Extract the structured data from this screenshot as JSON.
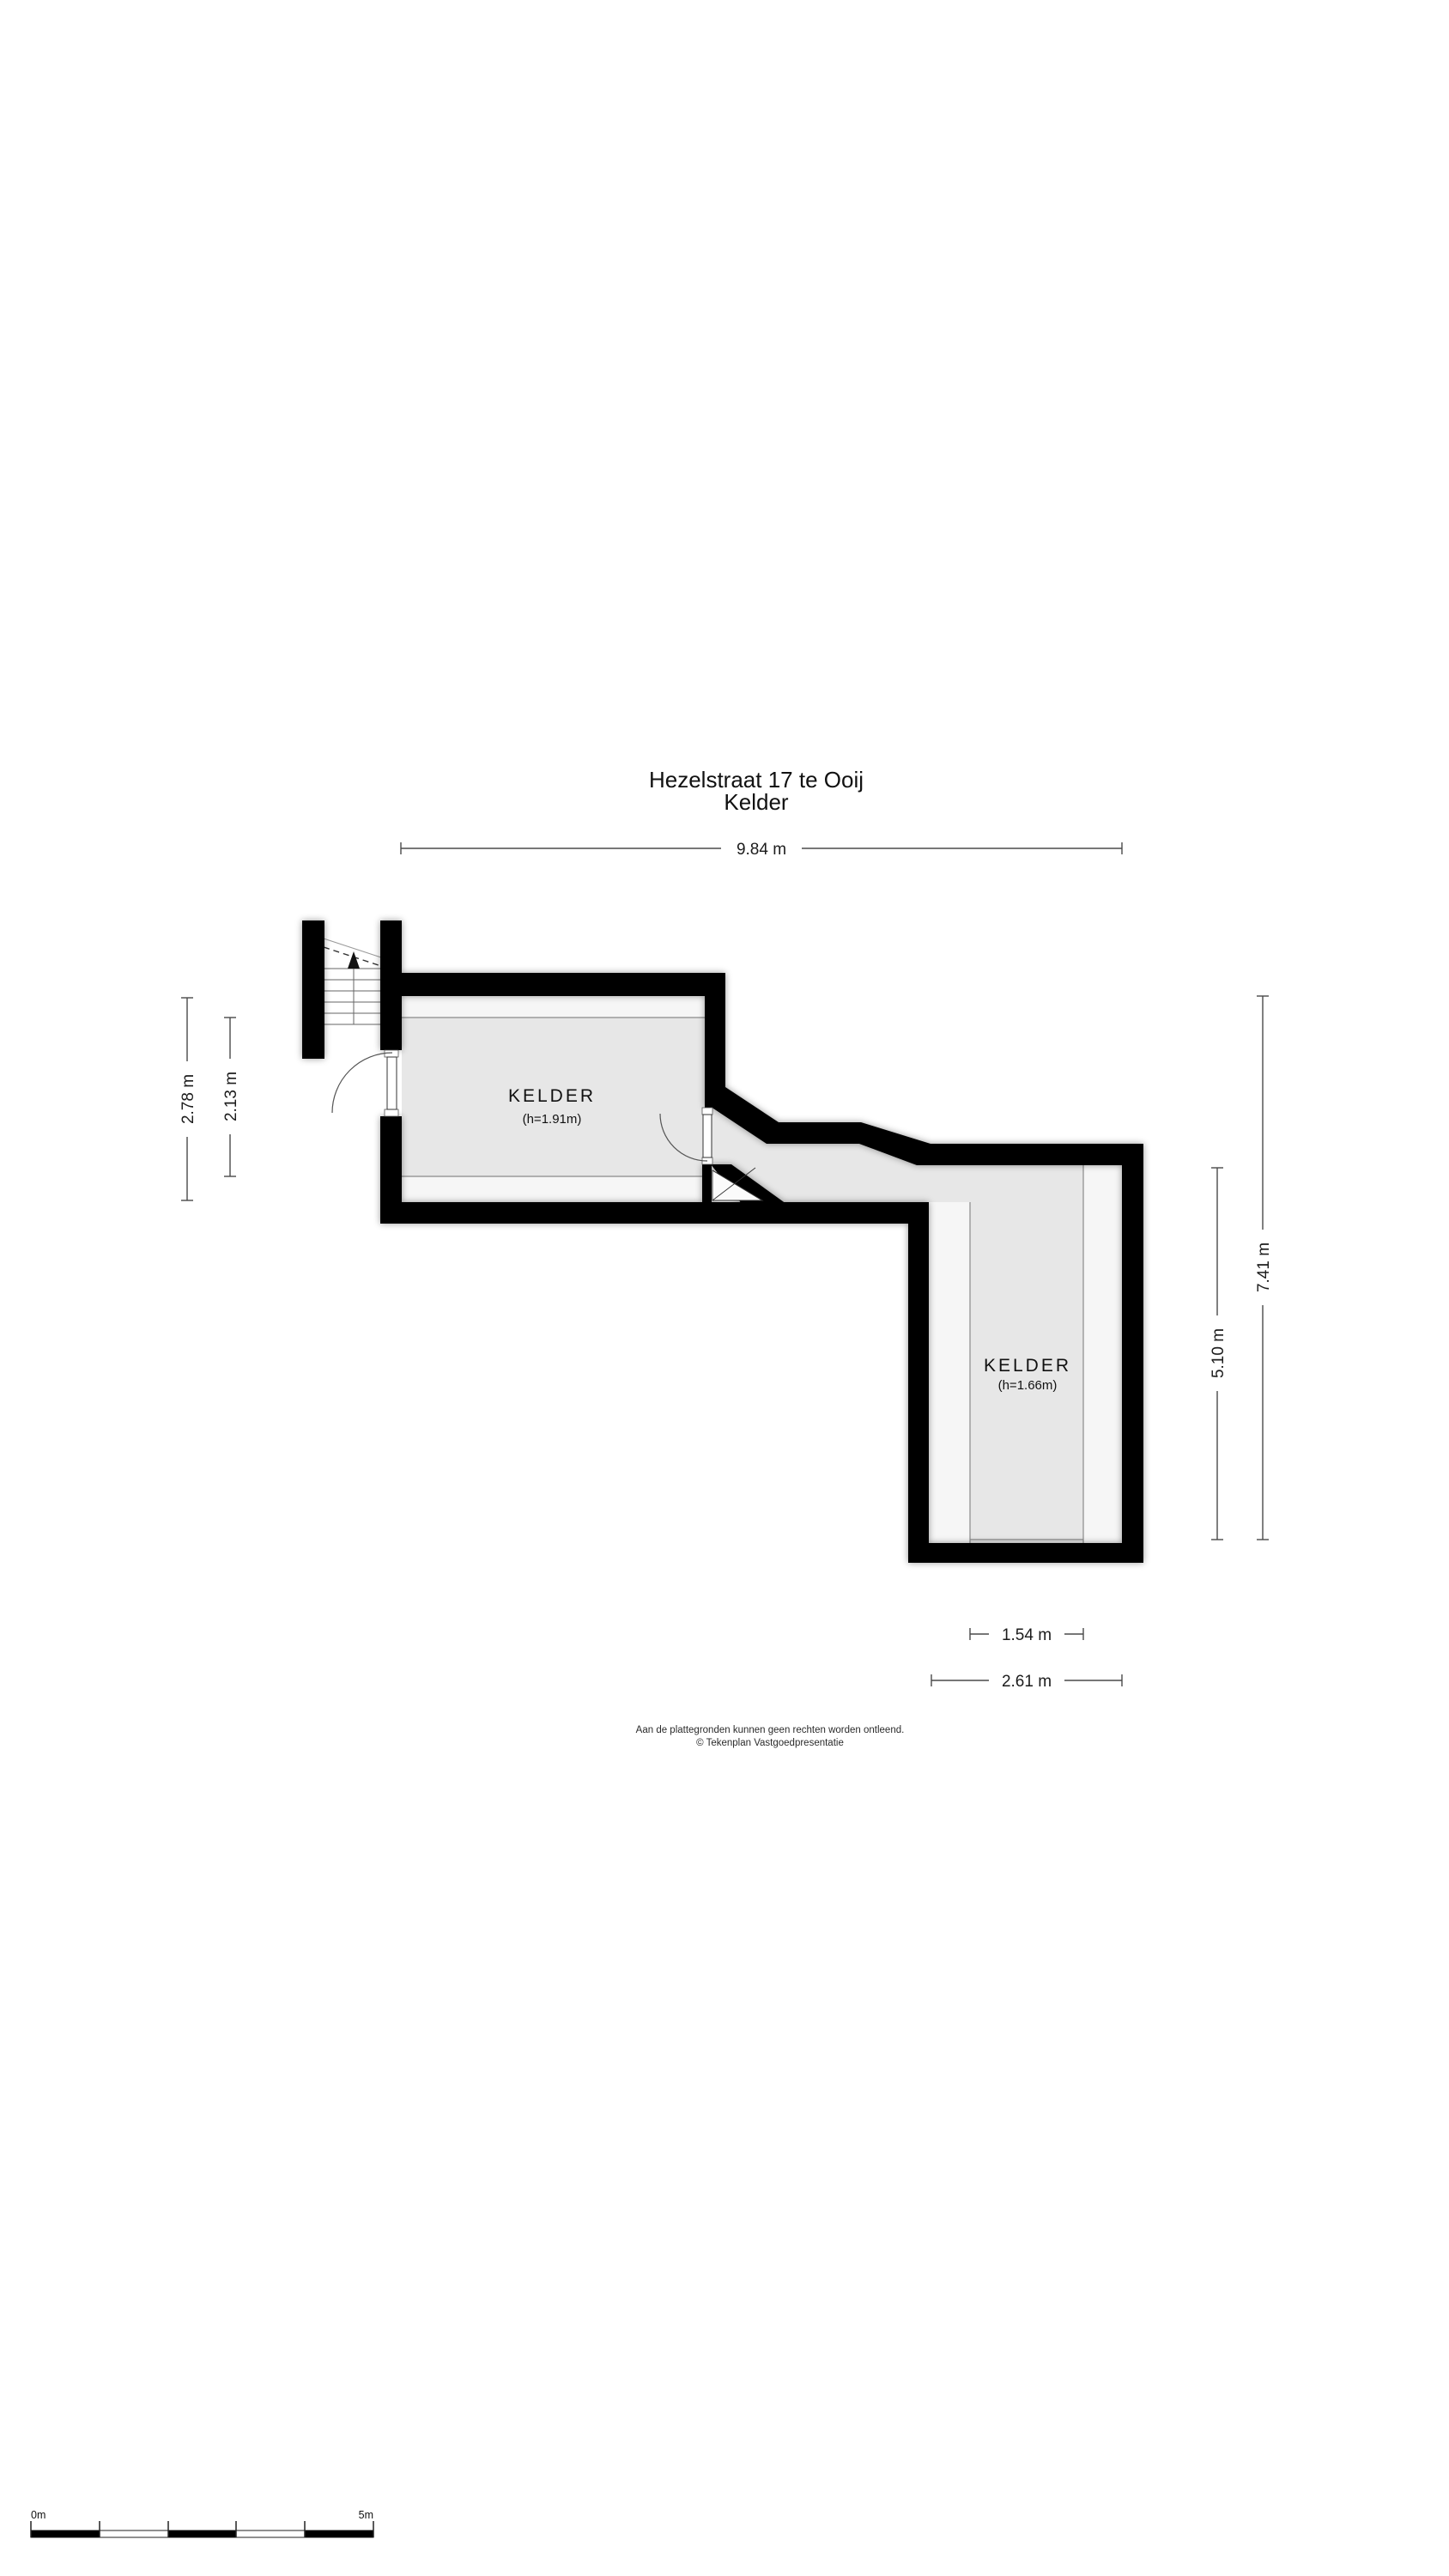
{
  "title": {
    "line1": "Hezelstraat 17 te Ooij",
    "line2": "Kelder"
  },
  "floorplan": {
    "room1": {
      "label": "KELDER",
      "height_note": "(h=1.91m)"
    },
    "room2": {
      "label": "KELDER",
      "height_note": "(h=1.66m)"
    },
    "dimensions": {
      "width_total": "9.84 m",
      "room1_height_outer": "2.78 m",
      "room1_height_inner": "2.13 m",
      "right_total": "7.41 m",
      "room2_height": "5.10 m",
      "room2_width_inner": "1.54 m",
      "room2_width_outer": "2.61 m"
    }
  },
  "footer": {
    "disclaimer_line1": "Aan de plattegronden kunnen geen rechten worden ontleend.",
    "disclaimer_line2": "© Tekenplan Vastgoedpresentatie"
  },
  "scale_bar": {
    "label_start": "0m",
    "label_end": "5m"
  },
  "colors": {
    "wall": "#000000",
    "floor_gray": "#e7e7e7",
    "floor_light": "#f6f6f6",
    "thin_line": "#8a8a8a",
    "dimension_line": "#4a4a4a",
    "text": "#111111"
  }
}
